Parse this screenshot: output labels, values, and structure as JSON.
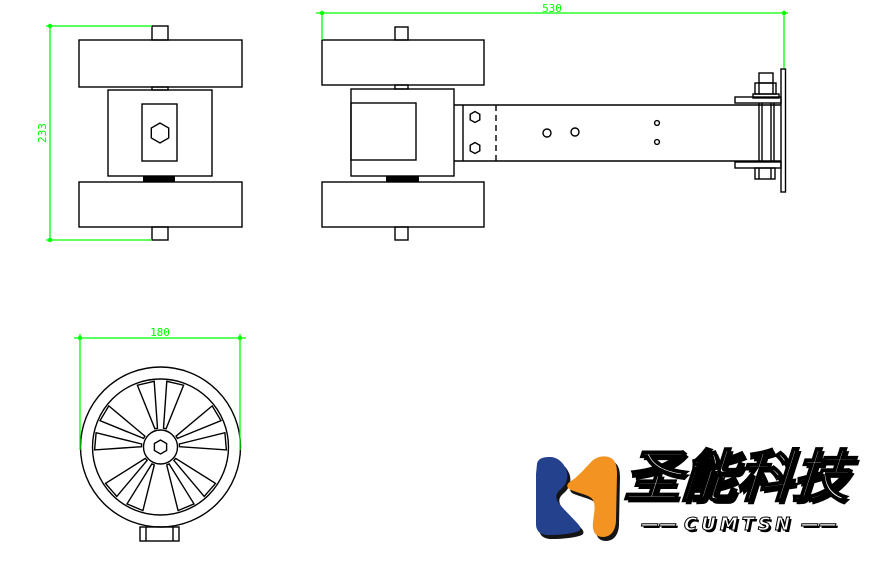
{
  "views": {
    "front": {
      "dimension": "233"
    },
    "side": {
      "dimension": "530"
    },
    "wheel": {
      "dimension": "180"
    }
  },
  "logo": {
    "company_name_cn": "圣能科技",
    "company_name_en": "CUMTSN",
    "dash_left": "——",
    "dash_right": "——"
  },
  "colors": {
    "background": "#ffffff",
    "line": "#000000",
    "dimension_green": "#00ff00",
    "logo_blue": "#24418e",
    "logo_orange": "#f39322",
    "logo_shadow": "#151515",
    "logo_text_fill": "#ffffff",
    "logo_text_outline": "#000000"
  }
}
